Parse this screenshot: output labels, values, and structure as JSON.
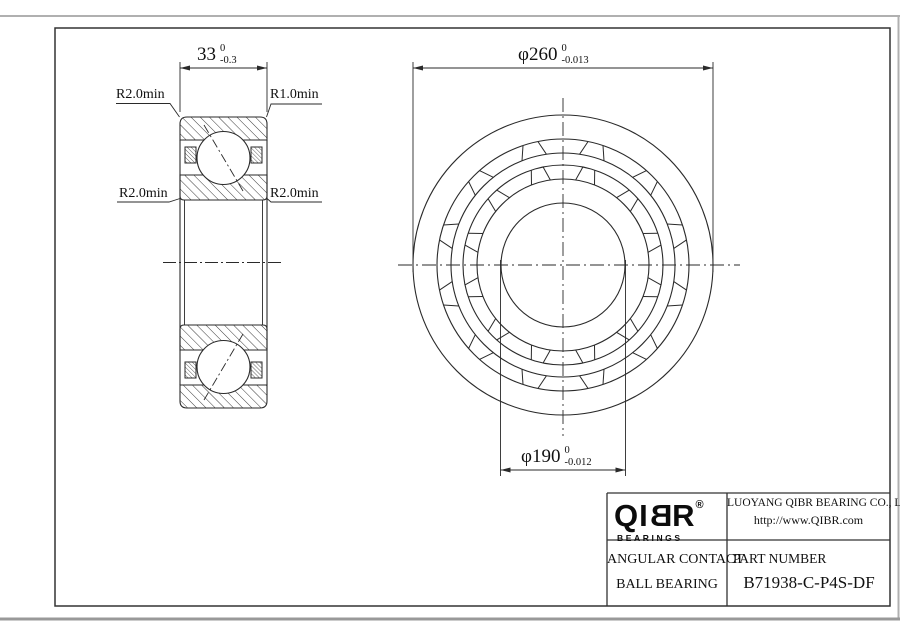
{
  "section_view": {
    "dim_width": {
      "text": "33",
      "tol_upper": "0",
      "tol_lower": "-0.3"
    },
    "labels": {
      "top_left": "R2.0min",
      "top_right": "R1.0min",
      "mid_left": "R2.0min",
      "mid_right": "R2.0min"
    }
  },
  "front_view": {
    "dim_od": {
      "text": "φ260",
      "tol_upper": "0",
      "tol_lower": "-0.013"
    },
    "dim_bore": {
      "text": "φ190",
      "tol_upper": "0",
      "tol_lower": "-0.012"
    }
  },
  "title_block": {
    "logo": {
      "part1": "QI",
      "part2": "B",
      "part3": "R",
      "registered": "®",
      "subtext": "BEARINGS"
    },
    "company": {
      "name": "LUOYANG QIBR BEARING CO., LTD",
      "url": "http://www.QIBR.com"
    },
    "description": {
      "line1": "ANGULAR CONTACT",
      "line2": "BALL BEARING"
    },
    "part": {
      "label": "PART NUMBER",
      "number": "B71938-C-P4S-DF"
    }
  },
  "colors": {
    "line": "#2a2a2a",
    "page_edge": "#b0b0b0"
  }
}
